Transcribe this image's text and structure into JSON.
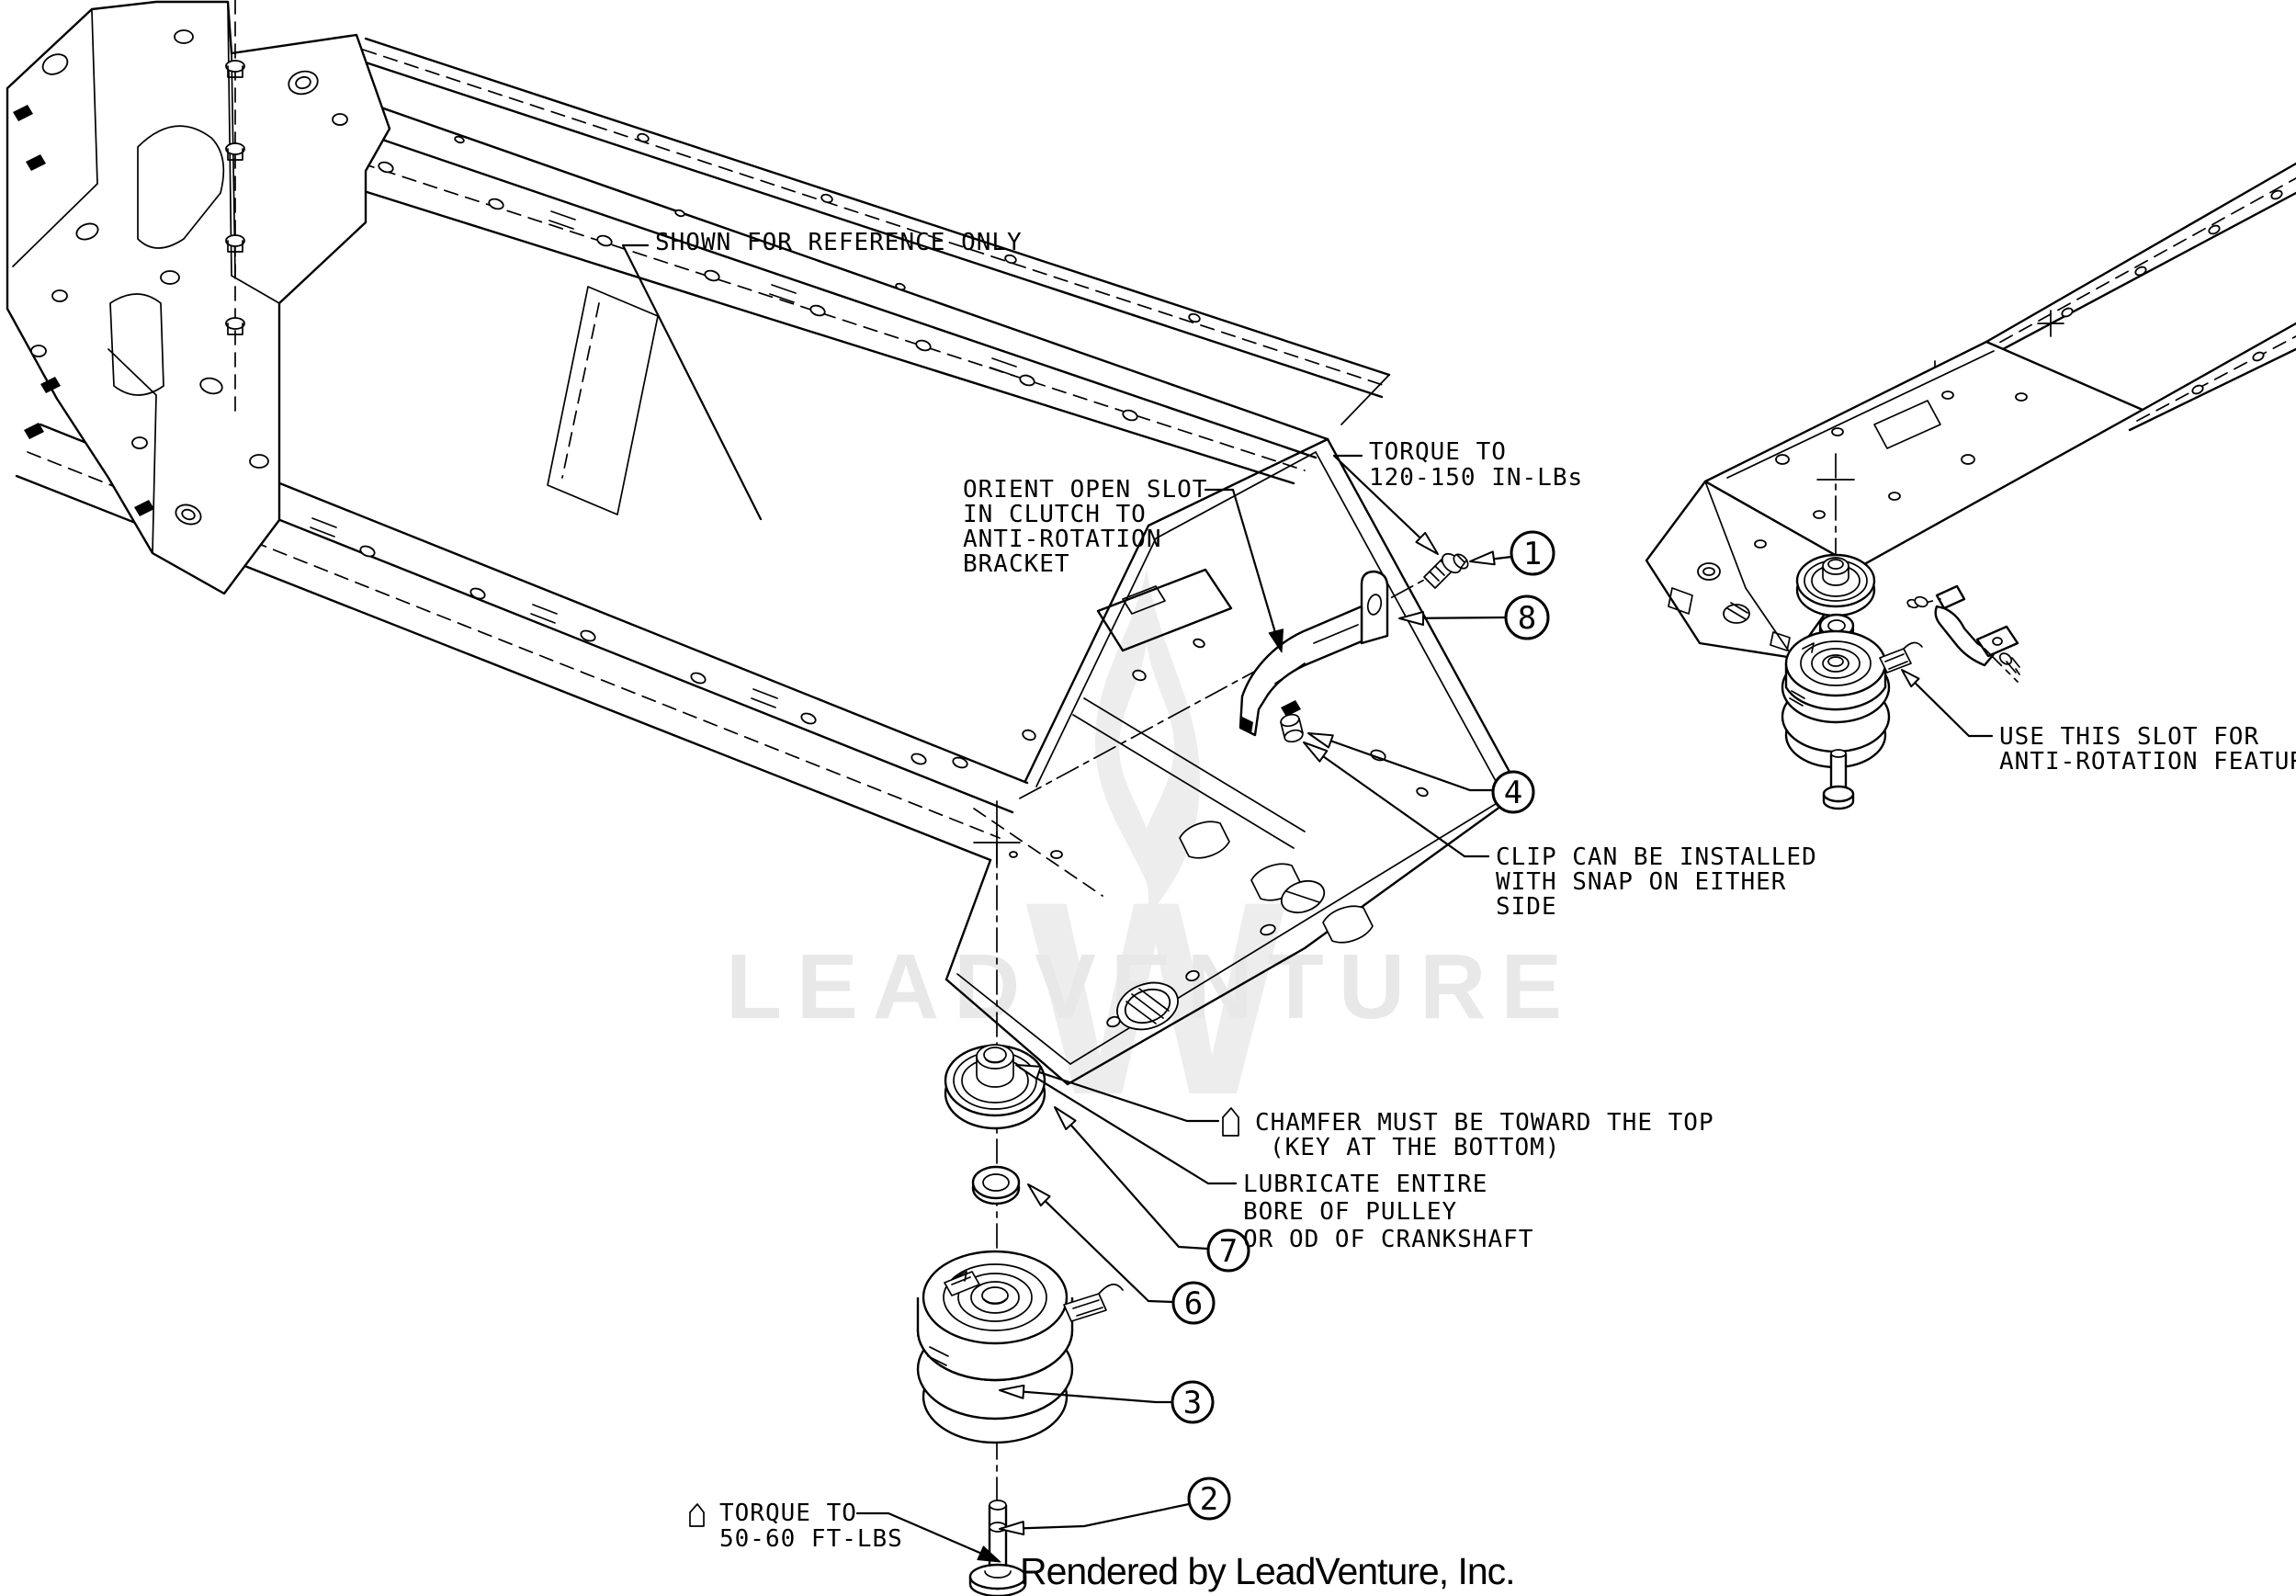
{
  "watermark": {
    "text": "LEADVENTURE",
    "logo": "flame-w-logo"
  },
  "credit": "Rendered by LeadVenture, Inc.",
  "annotations": {
    "reference": "SHOWN FOR REFERENCE ONLY",
    "torque_upper": [
      "TORQUE TO",
      "120-150 IN-LBs"
    ],
    "orient": [
      "ORIENT OPEN SLOT",
      "IN CLUTCH TO",
      "ANTI-ROTATION",
      "BRACKET"
    ],
    "use_slot": [
      "USE THIS SLOT FOR",
      "ANTI-ROTATION FEATURE"
    ],
    "clip": [
      "CLIP CAN BE INSTALLED",
      "WITH SNAP ON EITHER",
      "SIDE"
    ],
    "chamfer": [
      "CHAMFER MUST BE TOWARD THE TOP",
      "(KEY AT THE BOTTOM)"
    ],
    "lubricate": [
      "LUBRICATE ENTIRE",
      "BORE OF PULLEY",
      "OR OD OF CRANKSHAFT"
    ],
    "torque_lower": [
      "TORQUE TO",
      "50-60 FT-LBS"
    ]
  },
  "callouts": [
    {
      "number": "1"
    },
    {
      "number": "8"
    },
    {
      "number": "4"
    },
    {
      "number": "7"
    },
    {
      "number": "6"
    },
    {
      "number": "3"
    },
    {
      "number": "2"
    }
  ],
  "colors": {
    "line": "#000000",
    "watermark_text": "#e8e8e8",
    "watermark_logo": "#ededed"
  }
}
